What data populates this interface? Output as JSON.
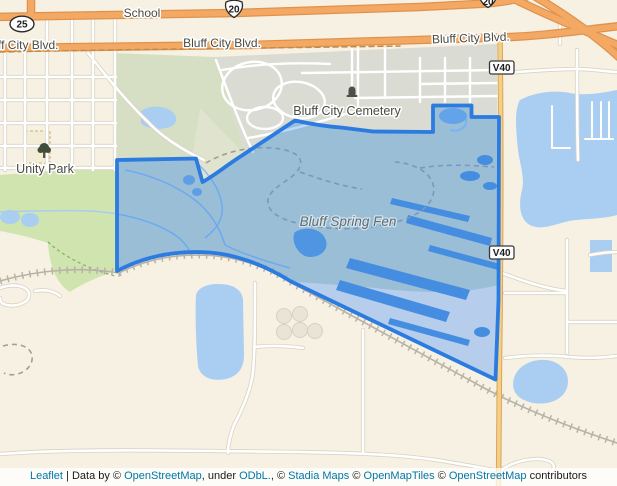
{
  "map": {
    "labels": {
      "school": "School",
      "blvd_left_partial": "ff City Blvd.",
      "blvd_mid": "Bluff City Blvd.",
      "blvd_right": "Bluff City Blvd.",
      "cemetery": "Bluff City Cemetery",
      "unity_park": "Unity Park",
      "fen": "Bluff Spring Fen"
    },
    "shields": {
      "route25": "25",
      "route20_top": "20",
      "route20_right": "20",
      "v40_upper": "V40",
      "v40_lower": "V40"
    },
    "icons": {
      "cemetery": "tombstone-icon",
      "park": "tree-icon"
    },
    "colors": {
      "land": "#f6f1e3",
      "water": "#a9cef2",
      "park_green": "#cfe4ae",
      "scrub_green": "#d6dfc3",
      "urban_gray": "#dadbd2",
      "road_primary": "#f3a963",
      "road_v40": "#f4cf86",
      "fen_fill": "#3388ff",
      "fen_stroke": "#2b7be0",
      "link": "#0078a8"
    }
  },
  "attribution": {
    "segments": {
      "s0": "Leaflet",
      "s1": " | Data by © ",
      "s2": "OpenStreetMap",
      "s3": ", under ",
      "s4": "ODbL.",
      "s5": ", © ",
      "s6": "Stadia Maps",
      "s7": " © ",
      "s8": "OpenMapTiles",
      "s9": " © ",
      "s10": "OpenStreetMap",
      "s11": " contributors"
    }
  }
}
